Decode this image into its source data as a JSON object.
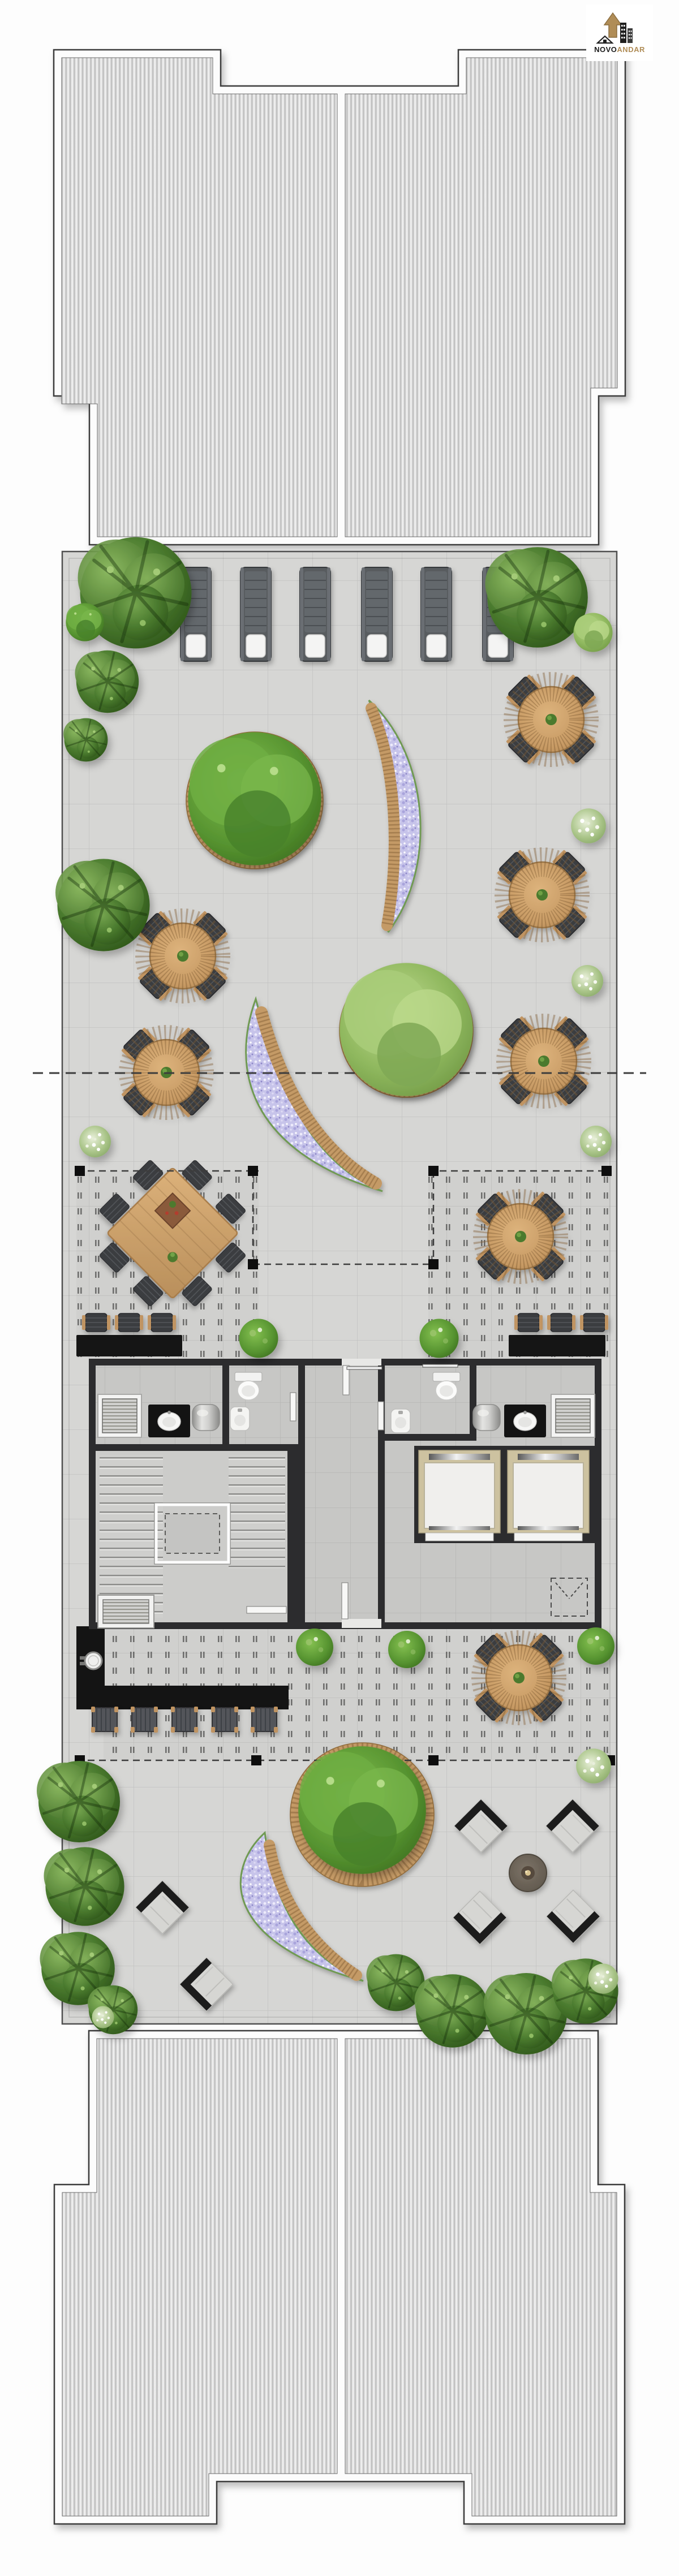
{
  "logo": {
    "brand_black": "NOVO",
    "brand_gold": "ANDAR"
  },
  "palette": {
    "accent_gold": "#b08d57",
    "wood": "#c49a66",
    "wood_dark": "#a87c49",
    "flower_lilac": "#c7c4ea",
    "tree_dark": "#47762c",
    "tree_light": "#a8cc7d",
    "paving": "#d6d6d4",
    "pergola_floor": "#d0d0ce",
    "core_wall": "#2c2c2e",
    "black_planter": "#151515",
    "lounger_gray": "#585b5f",
    "elevator_frame": "#cdc2a0",
    "roof_stripe_dark": "#b8b8b8",
    "roof_stripe_light": "#f4f4f4"
  },
  "inventory": {
    "roof_terrace_sun_loungers": 6,
    "lower_terrace_sun_loungers": 5,
    "round_dining_tables_with_4_chairs": 7,
    "pergola_dining_table_chairs": 8,
    "bar_chairs": 6,
    "lounge_diamond_armchairs": 6,
    "fire_pit": 1,
    "curved_flower_bench_planters": 3,
    "round_tree_planters_with_bench": 3,
    "elevators": 2,
    "stairwell": 1,
    "wc_rooms": 3,
    "pergola_posts": 10
  },
  "scene": {
    "tables": [
      [
        974,
        1272
      ],
      [
        958,
        1582
      ],
      [
        961,
        1876
      ],
      [
        323,
        1690
      ],
      [
        294,
        1896
      ],
      [
        920,
        2186
      ],
      [
        917,
        2966
      ]
    ],
    "loungersTop": [
      [
        346,
        1086
      ],
      [
        452,
        1086
      ],
      [
        557,
        1086
      ],
      [
        666,
        1086
      ],
      [
        771,
        1086
      ],
      [
        880,
        1086
      ]
    ],
    "loungersLow": [
      [
        185,
        3040
      ],
      [
        255,
        3040
      ],
      [
        326,
        3040
      ],
      [
        397,
        3040
      ],
      [
        467,
        3040
      ]
    ],
    "barChairs": [
      [
        170,
        2338
      ],
      [
        228,
        2338
      ],
      [
        286,
        2338
      ],
      [
        934,
        2338
      ],
      [
        992,
        2338
      ],
      [
        1050,
        2338
      ]
    ],
    "diamondChairs": [
      [
        850,
        3228,
        45
      ],
      [
        1012,
        3228,
        45
      ],
      [
        848,
        3390,
        225
      ],
      [
        1013,
        3388,
        225
      ],
      [
        287,
        3372,
        45
      ],
      [
        365,
        3508,
        315
      ]
    ],
    "posts": [
      [
        141,
        2070
      ],
      [
        447,
        2070
      ],
      [
        447,
        2235
      ],
      [
        766,
        2070
      ],
      [
        1072,
        2070
      ],
      [
        766,
        2235
      ],
      [
        141,
        3112
      ],
      [
        453,
        3112
      ],
      [
        766,
        3112
      ],
      [
        1078,
        3112
      ]
    ],
    "trees": [
      [
        240,
        1048,
        2.05,
        1
      ],
      [
        150,
        1100,
        0.7,
        2
      ],
      [
        190,
        1205,
        1.15,
        1
      ],
      [
        950,
        1056,
        1.85,
        1
      ],
      [
        1048,
        1118,
        0.72,
        3
      ],
      [
        152,
        1308,
        0.8,
        1
      ],
      [
        183,
        1600,
        1.7,
        1
      ],
      [
        450,
        1412,
        2.45,
        2
      ],
      [
        718,
        1820,
        2.45,
        3
      ],
      [
        640,
        3200,
        2.35,
        2
      ],
      [
        140,
        3185,
        1.5,
        1
      ],
      [
        150,
        3335,
        1.45,
        1
      ],
      [
        138,
        3480,
        1.35,
        1
      ],
      [
        200,
        3553,
        0.9,
        1
      ],
      [
        700,
        3505,
        1.05,
        1
      ],
      [
        800,
        3555,
        1.35,
        1
      ],
      [
        930,
        3560,
        1.5,
        1
      ],
      [
        1035,
        3520,
        1.2,
        1
      ]
    ],
    "bushesGreen": [
      [
        457,
        2366,
        1.15
      ],
      [
        776,
        2366,
        1.15
      ],
      [
        556,
        2912,
        1.1
      ],
      [
        719,
        2916,
        1.1
      ],
      [
        1053,
        2910,
        1.1
      ]
    ],
    "bushesWhite": [
      [
        1040,
        1460,
        1.1
      ],
      [
        1038,
        1734,
        1.0
      ],
      [
        1053,
        2018,
        1.0
      ],
      [
        168,
        2018,
        1.0
      ],
      [
        1049,
        3122,
        1.1
      ],
      [
        1066,
        3498,
        0.95
      ],
      [
        182,
        3566,
        0.7
      ]
    ],
    "firepit": [
      933,
      3311
    ]
  }
}
